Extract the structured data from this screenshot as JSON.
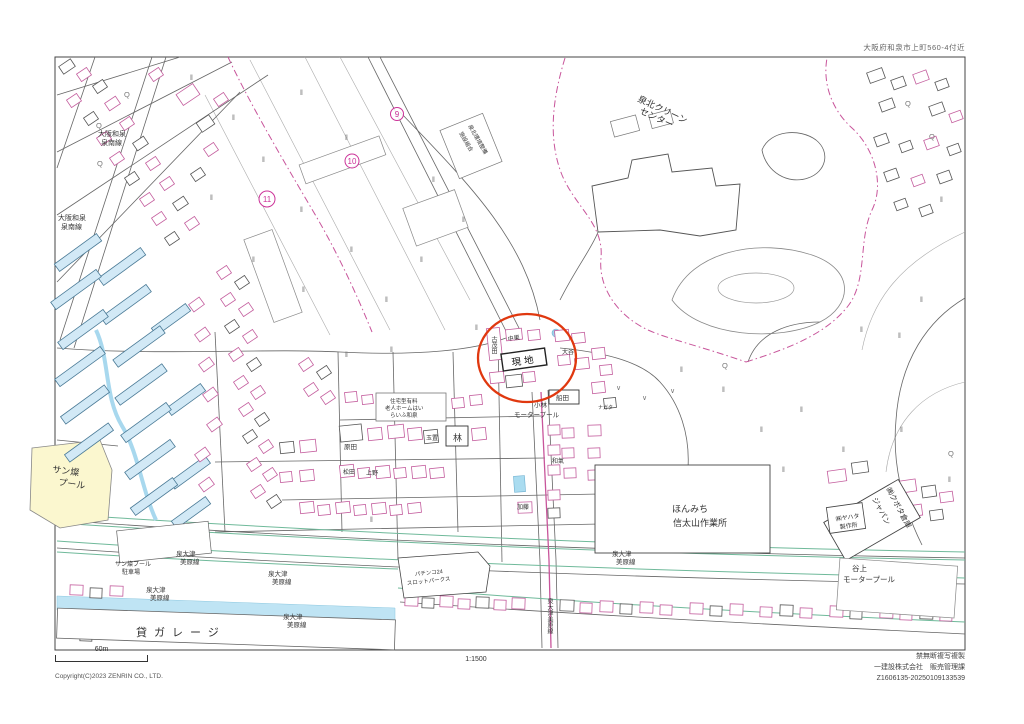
{
  "page": {
    "location_label": "大阪府和泉市上町560-4付近",
    "scale_text": "1:1500",
    "scale_bar_label": "60m",
    "copyright": "Copyright(C)2023 ZENRIN CO., LTD.",
    "notice": "禁無断複写複製",
    "publisher": "一建設株式会社　販売管理課",
    "serial": "Z1606135-20250109133539"
  },
  "map": {
    "site_label": "現地",
    "accent_colors": {
      "highlight_circle": "#e0380f",
      "boundary_magenta": "#c8559b",
      "area_marker": "#cc3399",
      "water": "#aadcf0",
      "road_green": "#6fb99a",
      "pool_yellow": "#fbf7cf"
    },
    "area_markers": [
      {
        "label": "9",
        "x": 397,
        "y": 114,
        "r": 6.5
      },
      {
        "label": "10",
        "x": 352,
        "y": 161,
        "r": 7
      },
      {
        "label": "11",
        "x": 267,
        "y": 199,
        "r": 8
      }
    ],
    "labels": [
      {
        "text": "泉北クリーン",
        "x": 637,
        "y": 101,
        "s": 9,
        "r": 25
      },
      {
        "text": "センター",
        "x": 639,
        "y": 113,
        "s": 9,
        "r": 25
      },
      {
        "text": "大阪和泉",
        "x": 98,
        "y": 136,
        "s": 7
      },
      {
        "text": "泉南線",
        "x": 101,
        "y": 145,
        "s": 7
      },
      {
        "text": "大阪和泉",
        "x": 58,
        "y": 220,
        "s": 7
      },
      {
        "text": "泉南線",
        "x": 61,
        "y": 229,
        "s": 7
      },
      {
        "text": "泉北環境整備",
        "x": 468,
        "y": 126,
        "s": 5.5,
        "r": 60
      },
      {
        "text": "施設組合",
        "x": 459,
        "y": 133,
        "s": 5.5,
        "r": 60
      },
      {
        "text": "サン燦",
        "x": 52,
        "y": 472,
        "s": 9,
        "r": 8
      },
      {
        "text": "プール",
        "x": 58,
        "y": 485,
        "s": 9,
        "r": 8
      },
      {
        "text": "小林",
        "x": 534,
        "y": 407,
        "s": 6.5
      },
      {
        "text": "モータープール",
        "x": 514,
        "y": 417,
        "s": 6.5
      },
      {
        "text": "住宅型有料",
        "x": 390,
        "y": 403,
        "s": 5.5
      },
      {
        "text": "老人ホームはい",
        "x": 385,
        "y": 410,
        "s": 5.5
      },
      {
        "text": "らいふ和泉",
        "x": 390,
        "y": 417,
        "s": 5.5
      },
      {
        "text": "ほんみち",
        "x": 690,
        "y": 512,
        "s": 9,
        "a": "m"
      },
      {
        "text": "信太山作業所",
        "x": 700,
        "y": 526,
        "s": 9,
        "a": "m"
      },
      {
        "text": "㈱クボタ倉庫",
        "x": 886,
        "y": 489,
        "s": 7.5,
        "r": 62
      },
      {
        "text": "ジャパン",
        "x": 872,
        "y": 499,
        "s": 7.5,
        "r": 62
      },
      {
        "text": "㈱ヤハタ",
        "x": 836,
        "y": 521,
        "s": 6,
        "r": -8
      },
      {
        "text": "製作所",
        "x": 840,
        "y": 529,
        "s": 6,
        "r": -8
      },
      {
        "text": "谷上",
        "x": 852,
        "y": 571,
        "s": 7.5
      },
      {
        "text": "モータープール",
        "x": 843,
        "y": 582,
        "s": 7.5
      },
      {
        "text": "サン燦プール",
        "x": 115,
        "y": 566,
        "s": 6
      },
      {
        "text": "駐車場",
        "x": 122,
        "y": 574,
        "s": 6
      },
      {
        "text": "泉大津",
        "x": 176,
        "y": 556,
        "s": 6.5
      },
      {
        "text": "美原線",
        "x": 180,
        "y": 564,
        "s": 6.5
      },
      {
        "text": "泉大津",
        "x": 268,
        "y": 576,
        "s": 6.5
      },
      {
        "text": "美原線",
        "x": 272,
        "y": 584,
        "s": 6.5
      },
      {
        "text": "泉大津",
        "x": 146,
        "y": 592,
        "s": 6.5
      },
      {
        "text": "美原線",
        "x": 150,
        "y": 600,
        "s": 6.5
      },
      {
        "text": "泉大津",
        "x": 283,
        "y": 619,
        "s": 6.5
      },
      {
        "text": "美原線",
        "x": 287,
        "y": 627,
        "s": 6.5
      },
      {
        "text": "泉大津",
        "x": 612,
        "y": 556,
        "s": 6.5
      },
      {
        "text": "美原線",
        "x": 616,
        "y": 564,
        "s": 6.5
      },
      {
        "text": "泉大津美原線",
        "x": 549,
        "y": 598,
        "s": 6,
        "v": true
      },
      {
        "text": "貸ガレージ",
        "x": 136,
        "y": 636,
        "s": 11,
        "ls": 7
      },
      {
        "text": "パチンコ24",
        "x": 415,
        "y": 576,
        "s": 5.5,
        "r": -6
      },
      {
        "text": "スロットパークス",
        "x": 407,
        "y": 585,
        "s": 5.5,
        "r": -6
      },
      {
        "text": "古茂田",
        "x": 493,
        "y": 336,
        "s": 6,
        "v": true
      },
      {
        "text": "中巣",
        "x": 508,
        "y": 341,
        "s": 6,
        "r": -8
      },
      {
        "text": "大谷",
        "x": 562,
        "y": 354,
        "s": 6
      },
      {
        "text": "船田",
        "x": 556,
        "y": 400,
        "s": 6.5
      },
      {
        "text": "ナガタ",
        "x": 598,
        "y": 409,
        "s": 5
      },
      {
        "text": "原田",
        "x": 344,
        "y": 449,
        "s": 6.5
      },
      {
        "text": "松田",
        "x": 343,
        "y": 474,
        "s": 6
      },
      {
        "text": "上野",
        "x": 366,
        "y": 475,
        "s": 6
      },
      {
        "text": "玉置",
        "x": 426,
        "y": 440,
        "s": 6
      },
      {
        "text": "林",
        "x": 453,
        "y": 441,
        "s": 9
      },
      {
        "text": "加藤",
        "x": 517,
        "y": 509,
        "s": 6
      },
      {
        "text": "和氣",
        "x": 552,
        "y": 463,
        "s": 6
      }
    ],
    "field_marks": [
      [
        190,
        80
      ],
      [
        232,
        120
      ],
      [
        300,
        95
      ],
      [
        345,
        140
      ],
      [
        262,
        162
      ],
      [
        210,
        200
      ],
      [
        300,
        212
      ],
      [
        350,
        252
      ],
      [
        302,
        292
      ],
      [
        252,
        262
      ],
      [
        385,
        302
      ],
      [
        420,
        262
      ],
      [
        462,
        222
      ],
      [
        432,
        182
      ],
      [
        475,
        330
      ],
      [
        345,
        357
      ],
      [
        390,
        352
      ],
      [
        680,
        372
      ],
      [
        722,
        392
      ],
      [
        760,
        432
      ],
      [
        800,
        412
      ],
      [
        842,
        452
      ],
      [
        900,
        432
      ],
      [
        920,
        302
      ],
      [
        940,
        202
      ],
      [
        860,
        332
      ],
      [
        782,
        472
      ],
      [
        948,
        482
      ],
      [
        370,
        522
      ],
      [
        898,
        338
      ]
    ],
    "tree_marks": [
      [
        96,
        128
      ],
      [
        124,
        97
      ],
      [
        97,
        166
      ],
      [
        905,
        106
      ],
      [
        929,
        139
      ],
      [
        722,
        368
      ],
      [
        948,
        456
      ]
    ],
    "check_marks": [
      [
        616,
        390
      ],
      [
        642,
        400
      ],
      [
        670,
        393
      ]
    ]
  }
}
